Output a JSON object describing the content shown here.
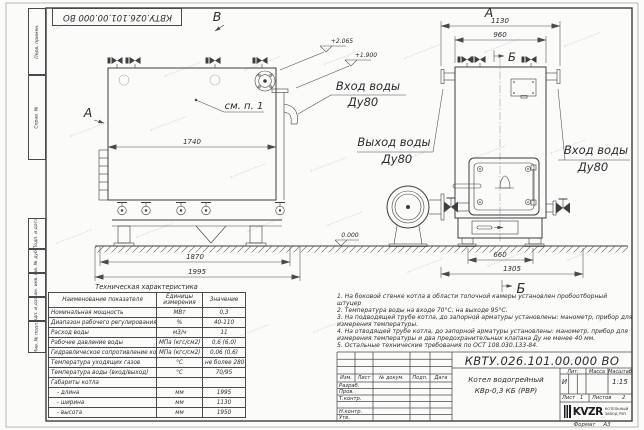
{
  "colors": {
    "paper": "#fbfbf9",
    "ink": "#3e3e40"
  },
  "sheet": {
    "stamp_top": "КВТУ.026.101.00.000 ВО",
    "format_label": "Формат",
    "format_value": "А3",
    "side_cells": [
      "Перв. примен.",
      "Справ. №",
      "Подп. и дата",
      "Инв. № дубл.",
      "Взам. инв. №",
      "Подп. и дата",
      "Инв. № подл."
    ]
  },
  "drawing": {
    "view_labels": {
      "left_top": "В",
      "left_side": "А",
      "right_top": "А",
      "section_top": "Б",
      "section_bottom": "Б"
    },
    "callouts": {
      "see_item": "см. п. 1",
      "inlet_left": {
        "line1": "Вход воды",
        "line2": "Ду80"
      },
      "outlet": {
        "line1": "Выход воды",
        "line2": "Ду80"
      },
      "inlet_right": {
        "line1": "Вход воды",
        "line2": "Ду80"
      }
    },
    "elevations": {
      "top": "+2.065",
      "mid": "+1.900",
      "zero": "0.000"
    },
    "dimensions": {
      "left_view": [
        "1740",
        "1870",
        "1995"
      ],
      "right_view": [
        "1130",
        "960",
        "660",
        "1305"
      ]
    }
  },
  "tech_table": {
    "title": "Техническая характеристика",
    "headers": [
      "Наименование показателя",
      "Единицы измерения",
      "Значение"
    ],
    "rows": [
      {
        "name": "Номинальная мощность",
        "unit": "МВт",
        "value": "0,3"
      },
      {
        "name": "Диапазон рабочего регулирования",
        "unit": "%",
        "value": "40-110"
      },
      {
        "name": "Расход воды",
        "unit": "м3/ч",
        "value": "11"
      },
      {
        "name": "Рабочее давление воды",
        "unit": "МПа (кгс/см2)",
        "value": "0,6 (6,0)"
      },
      {
        "name": "Гидравлическое сопротивление котла",
        "unit": "МПа (кгс/см2)",
        "value": "0,06 (0,6)"
      },
      {
        "name": "Температура уходящих газов",
        "unit": "°С",
        "value": "не более 280"
      },
      {
        "name": "Температура воды (вход/выход)",
        "unit": "°С",
        "value": "70/95"
      },
      {
        "name": "Габариты котла",
        "unit": "",
        "value": ""
      },
      {
        "name": "- длина",
        "unit": "мм",
        "value": "1995"
      },
      {
        "name": "- ширина",
        "unit": "мм",
        "value": "1130"
      },
      {
        "name": "- высота",
        "unit": "мм",
        "value": "1950"
      }
    ]
  },
  "notes": [
    "1. На боковой стенке котла в области топочной камеры установлен пробоотборный штуцер",
    "2. Температура воды на входе 70°С, на выходе 95°С.",
    "3. На подводящей трубе котла, до запорной арматуры установлены: манометр, прибор для измерения температуры.",
    "4. На отводящей трубе котла, до запорной арматуры установлены: манометр, прибор для измерения температуры и два предохранительных клапана Ду не менее 40 мм.",
    "5. Остальные технические требования по ОСТ 108.030.133-84."
  ],
  "title_block": {
    "doc_number": "КВТУ.026.101.00.000 ВО",
    "product_name_line1": "Котел водогрейный",
    "product_name_line2": "КВр-0,3 КБ (РВР)",
    "header_cols": [
      "Изм.",
      "Лист",
      "№ докум.",
      "Подп.",
      "Дата"
    ],
    "sign_rows": [
      "Разраб.",
      "Пров.",
      "Т.контр.",
      "Н.контр.",
      "Утв."
    ],
    "lit_header": "Лит.",
    "mass_header": "Масса",
    "scale_header": "Масштаб",
    "lit_value": "И",
    "scale_value": "1:15",
    "sheet_label": "Лист",
    "sheet_value": "1",
    "sheets_label": "Листов",
    "sheets_value": "2",
    "logo_text": "KVZR",
    "logo_sub1": "КОТЕЛЬНЫЙ",
    "logo_sub2": "ЗАВОД РЭП"
  }
}
